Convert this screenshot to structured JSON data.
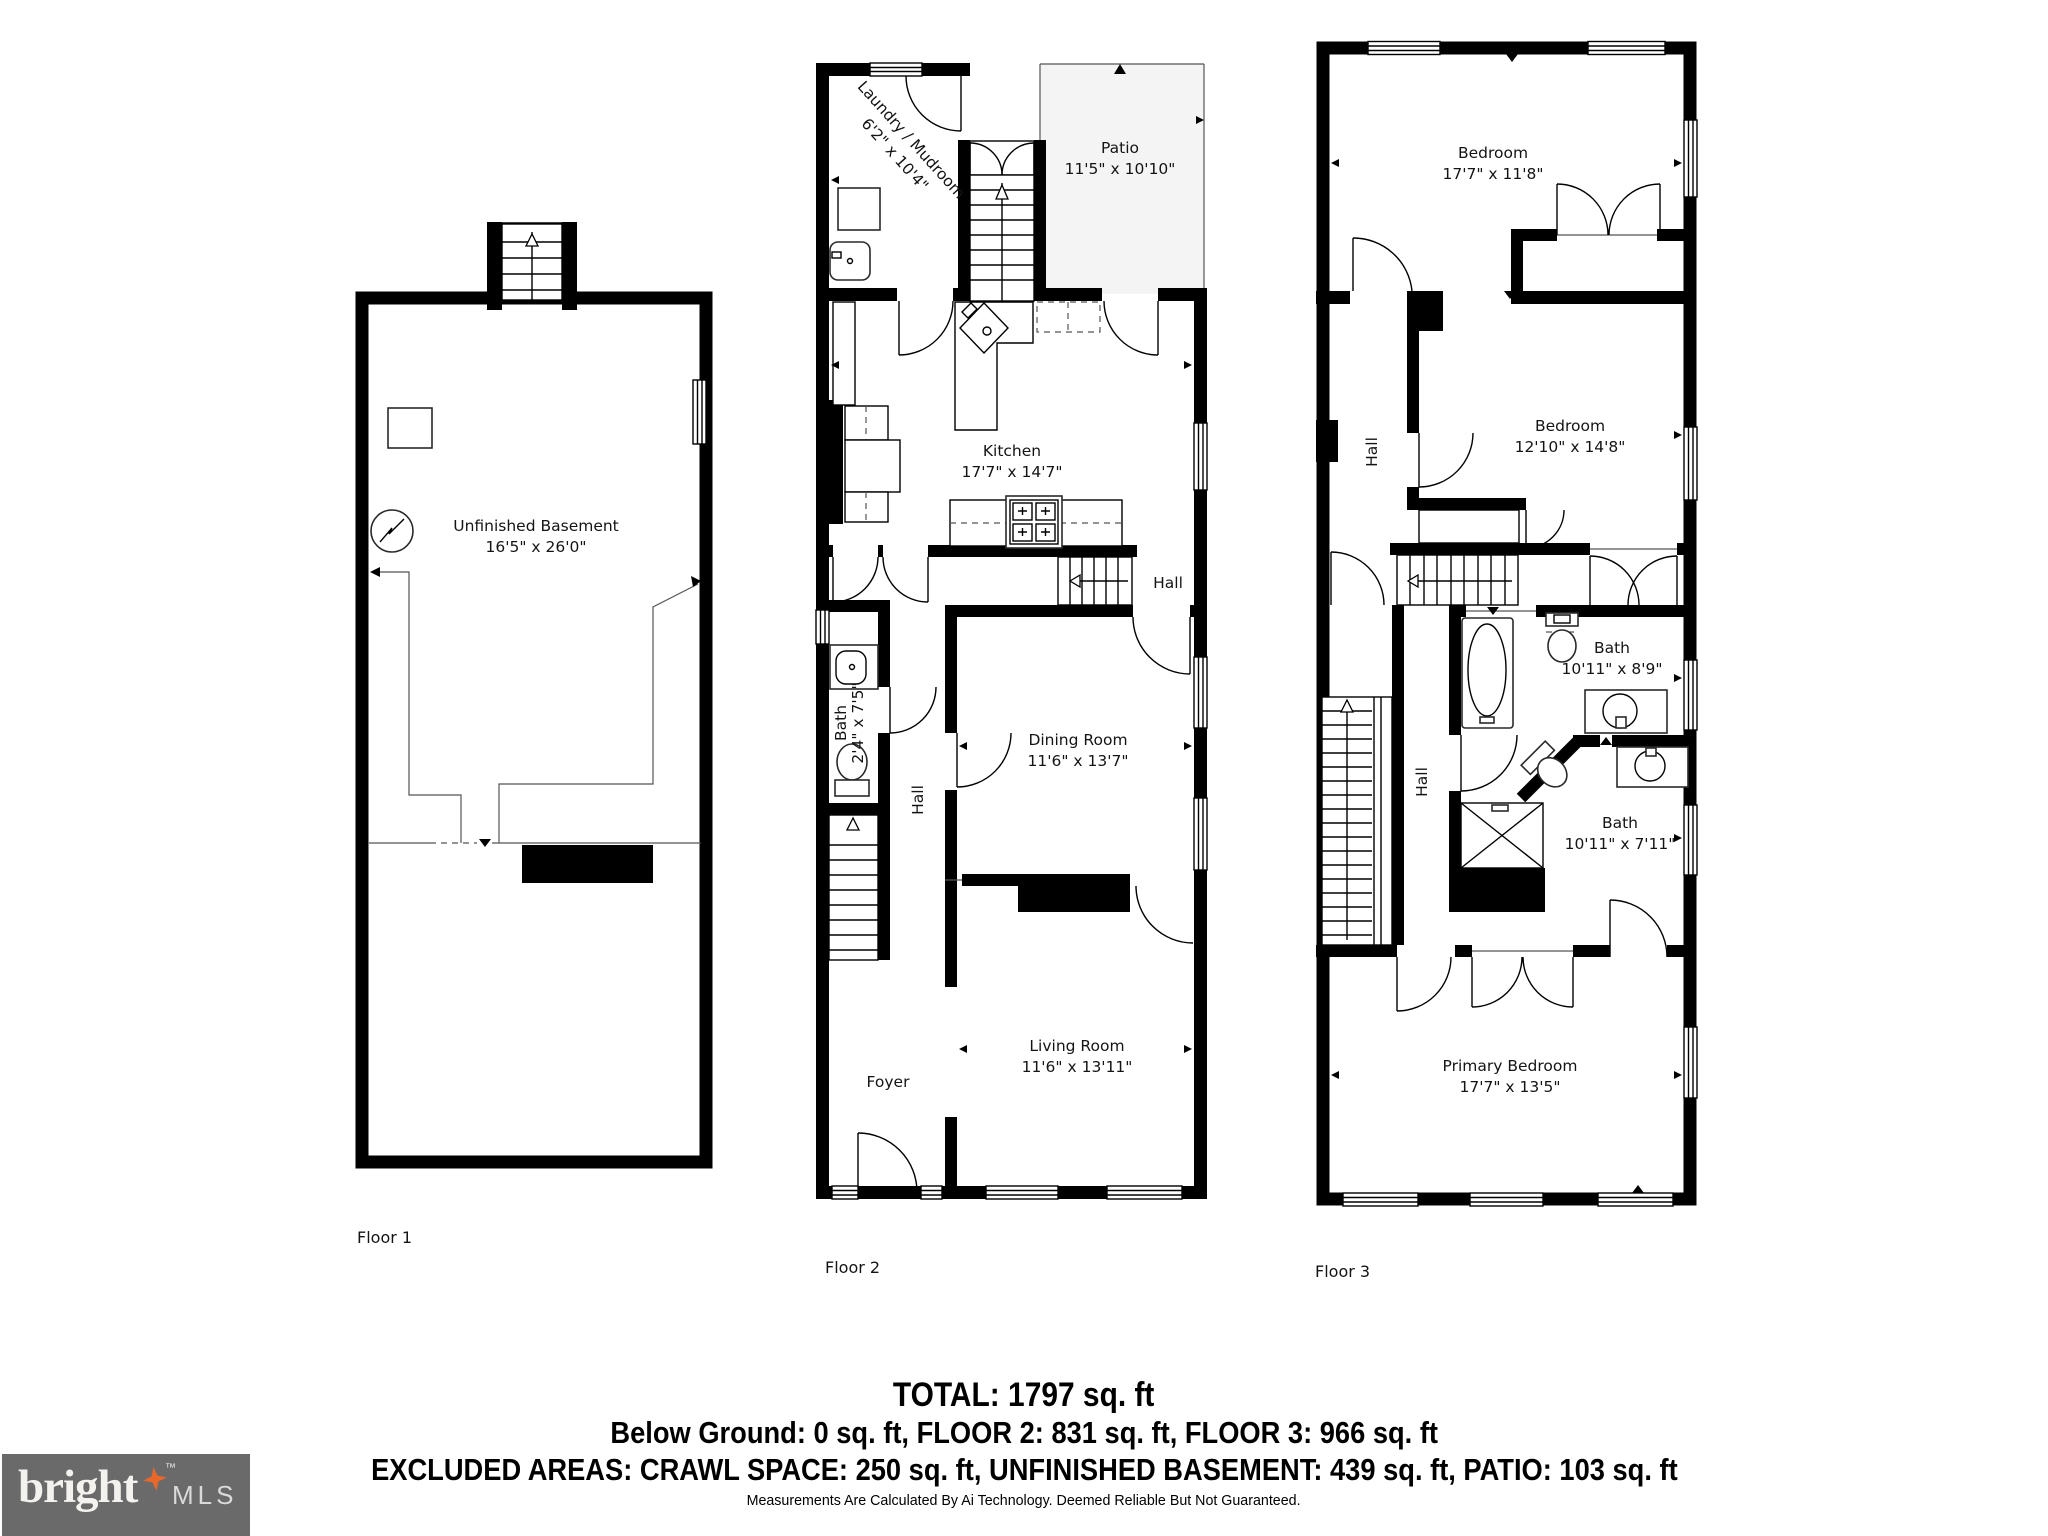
{
  "colors": {
    "wall": "#000000",
    "patio_fill": "#f4f4f4",
    "logo_bg": "#6a6a6a",
    "logo_star": "#e8682c"
  },
  "floors": {
    "floor1": {
      "label": "Floor 1",
      "rooms": {
        "basement": {
          "name": "Unfinished Basement",
          "dims": "16'5\" x 26'0\""
        }
      }
    },
    "floor2": {
      "label": "Floor 2",
      "rooms": {
        "laundry": {
          "name": "Laundry / Mudroom",
          "dims": "6'2\" x 10'4\""
        },
        "patio": {
          "name": "Patio",
          "dims": "11'5\" x 10'10\""
        },
        "kitchen": {
          "name": "Kitchen",
          "dims": "17'7\" x 14'7\""
        },
        "hall_upper": {
          "name": "Hall"
        },
        "bath": {
          "name": "Bath",
          "dims": "2'4\" x 7'5\""
        },
        "hall_lower": {
          "name": "Hall"
        },
        "dining": {
          "name": "Dining Room",
          "dims": "11'6\" x 13'7\""
        },
        "foyer": {
          "name": "Foyer"
        },
        "living": {
          "name": "Living Room",
          "dims": "11'6\" x 13'11\""
        }
      }
    },
    "floor3": {
      "label": "Floor 3",
      "rooms": {
        "bedroom1": {
          "name": "Bedroom",
          "dims": "17'7\" x 11'8\""
        },
        "hall_upper": {
          "name": "Hall"
        },
        "bedroom2": {
          "name": "Bedroom",
          "dims": "12'10\" x 14'8\""
        },
        "bath1": {
          "name": "Bath",
          "dims": "10'11\" x 8'9\""
        },
        "hall_lower": {
          "name": "Hall"
        },
        "bath2": {
          "name": "Bath",
          "dims": "10'11\" x 7'11\""
        },
        "primary": {
          "name": "Primary Bedroom",
          "dims": "17'7\" x 13'5\""
        }
      }
    }
  },
  "footer": {
    "total": "TOTAL: 1797 sq. ft",
    "line2": "Below Ground: 0 sq. ft, FLOOR 2: 831 sq. ft, FLOOR 3: 966 sq. ft",
    "line3": "EXCLUDED AREAS: CRAWL SPACE: 250 sq. ft, UNFINISHED BASEMENT: 439 sq. ft, PATIO: 103 sq. ft",
    "disclaimer": "Measurements Are Calculated By Ai Technology. Deemed Reliable But Not Guaranteed."
  },
  "logo": {
    "brand": "bright",
    "suffix": "MLS",
    "tm": "™"
  }
}
